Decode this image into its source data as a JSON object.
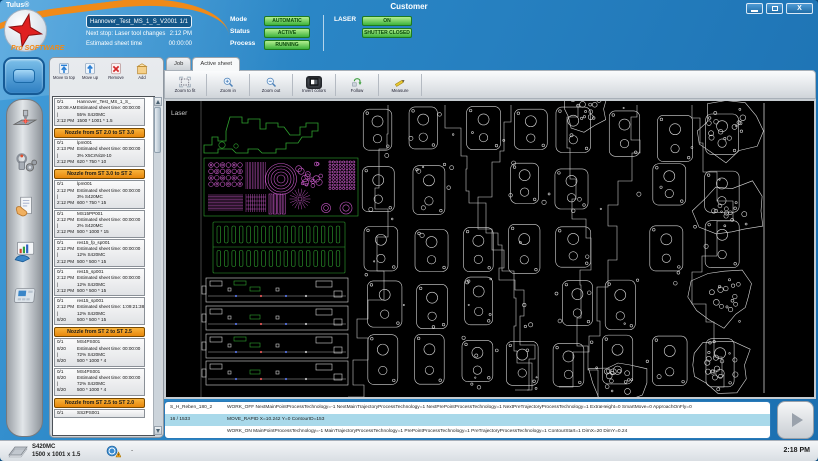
{
  "titlebar": {
    "app_name": "Tulus®",
    "window_title": "Customer"
  },
  "header": {
    "brand": "Pro SOFTWARE",
    "program_name": "Hannover_Test_MS_1_S_V2001",
    "program_count": "1/1",
    "next_stop_label": "Next stop: Laser tool changes",
    "next_stop_value": "2:12 PM",
    "est_sheet_time_label": "Estimated sheet time",
    "est_sheet_time_value": "00:00:00",
    "mode": {
      "label": "Mode",
      "value": "AUTOMATIC"
    },
    "status": {
      "label": "Status",
      "value": "ACTIVE"
    },
    "process": {
      "label": "Process",
      "value": "RUNNING"
    },
    "laser": {
      "label": "LASER",
      "state": "ON",
      "shutter": "SHUTTER CLOSED"
    }
  },
  "sidebar": {
    "active_item": {
      "name": "machine-home-icon"
    },
    "icons": [
      {
        "name": "laser-tool-icon"
      },
      {
        "name": "tool-setup-icon"
      },
      {
        "name": "job-documents-icon"
      },
      {
        "name": "reports-icon"
      },
      {
        "name": "control-panel-icon"
      }
    ]
  },
  "job_panel": {
    "toolbar": [
      {
        "icon": "move-to-top",
        "label": "Move to top"
      },
      {
        "icon": "move-up",
        "label": "Move up"
      },
      {
        "icon": "remove",
        "label": "Remove"
      },
      {
        "icon": "add",
        "label": "Add"
      }
    ],
    "list": [
      {
        "type": "item",
        "rows": [
          [
            "0/1",
            "Hannover_Test_MS_1_S_"
          ],
          [
            "10:08 AM",
            "Estimated sheet time: 00:00:00"
          ],
          [
            "|",
            "55% S420MC"
          ],
          [
            "2:12 PM",
            "1500 * 1001 * 1.5"
          ]
        ]
      },
      {
        "type": "header",
        "label": "Nozzle from ST 2.0 to ST 3.0"
      },
      {
        "type": "item",
        "rows": [
          [
            "0/1",
            "lpm001"
          ],
          [
            "2:13 PM",
            "Estimated sheet time: 00:00:00"
          ],
          [
            "|",
            "3% X5CrNi18-10"
          ],
          [
            "2:12 PM",
            "620 * 750 * 10"
          ]
        ]
      },
      {
        "type": "header",
        "label": "Nozzle from ST 3.0 to ST 2"
      },
      {
        "type": "item",
        "rows": [
          [
            "0/1",
            "lpm001"
          ],
          [
            "2:12 PM",
            "Estimated sheet time: 00:00:00"
          ],
          [
            "|",
            "3% S420MC"
          ],
          [
            "2:12 PM",
            "600 * 750 * 15"
          ]
        ]
      },
      {
        "type": "item",
        "rows": [
          [
            "0/1",
            "MS15PP001"
          ],
          [
            "2:12 PM",
            "Estimated sheet time: 00:00:00"
          ],
          [
            "|",
            "2% S420MC"
          ],
          [
            "2:12 PM",
            "500 * 1000 * 15"
          ]
        ]
      },
      {
        "type": "item",
        "rows": [
          [
            "0/1",
            "res15_fp_sp001"
          ],
          [
            "2:12 PM",
            "Estimated sheet time: 00:00:00"
          ],
          [
            "|",
            "12% S420MC"
          ],
          [
            "2:12 PM",
            "500 * 500 * 15"
          ]
        ]
      },
      {
        "type": "item",
        "rows": [
          [
            "0/1",
            "res15_sp001"
          ],
          [
            "2:12 PM",
            "Estimated sheet time: 00:00:00"
          ],
          [
            "|",
            "12% S420MC"
          ],
          [
            "2:12 PM",
            "500 * 500 * 15"
          ]
        ]
      },
      {
        "type": "item",
        "rows": [
          [
            "0/1",
            "res15_sp001"
          ],
          [
            "2:12 PM",
            "Estimated sheet time: 1:09:21:38"
          ],
          [
            "|",
            "12% S420MC"
          ],
          [
            "8/20",
            "500 * 500 * 15"
          ]
        ]
      },
      {
        "type": "header",
        "label": "Nozzle from ST 2 to ST 2.5"
      },
      {
        "type": "item",
        "rows": [
          [
            "0/1",
            "MS4PS001"
          ],
          [
            "8/20",
            "Estimated sheet time: 00:00:00"
          ],
          [
            "|",
            "72% S420MC"
          ],
          [
            "8/20",
            "500 * 1000 * 4"
          ]
        ]
      },
      {
        "type": "item",
        "rows": [
          [
            "0/1",
            "MS4PS001"
          ],
          [
            "8/20",
            "Estimated sheet time: 00:00:00"
          ],
          [
            "|",
            "72% S420MC"
          ],
          [
            "8/20",
            "500 * 1000 * 4"
          ]
        ]
      },
      {
        "type": "header",
        "label": "Nozzle from ST 2.5 to ST 2.0"
      },
      {
        "type": "item",
        "rows": [
          [
            "0/1",
            "SS2PS001"
          ]
        ]
      }
    ]
  },
  "main": {
    "tabs": [
      {
        "label": "Job",
        "active": false
      },
      {
        "label": "Active sheet",
        "active": true
      }
    ],
    "toolbar": [
      {
        "icon": "zoom-to-fit",
        "label": "Zoom to fit"
      },
      {
        "icon": "zoom-in",
        "label": "Zoom in"
      },
      {
        "icon": "zoom-out",
        "label": "Zoom out"
      },
      {
        "icon": "invert-colors",
        "label": "Invert colors",
        "pressed": true
      },
      {
        "icon": "follow",
        "label": "Follow"
      },
      {
        "icon": "measure",
        "label": "Measure"
      }
    ],
    "canvas_label": "Laser",
    "nc_lines": [
      {
        "label": "S_H_Reben_180_2",
        "text": "WORK_OFF  NextMainPointProcessTechnology=-1  NextMainTrajectoryProcessTechnology=1  NextPrePointProcessTechnology=1  NextPreTrajectoryProcessTechnology=1  ExtraHeight=0  SmartMove=0  ApproachOnFly=0",
        "highlight": false
      },
      {
        "label": "16 / 1533",
        "text": "MOVE_RAPID X=10.242 Y=0 ContourID=153",
        "highlight": true
      },
      {
        "label": "",
        "text": "WORK_ON  MainPointProcessTechnology=-1  MainTrajectoryProcessTechnology=1  PrePointProcessTechnology=1  PreTrajectoryProcessTechnology=1  ContourStart=1  DimX=20  DimY=0.24",
        "highlight": false
      }
    ]
  },
  "statusbar": {
    "material": "S420MC",
    "sheet_size": "1500 x 1001 x 1.5",
    "separator": "-",
    "clock": "2:18 PM"
  },
  "colors": {
    "accent_blue": "#2a86c6",
    "badge_green": "#3cb23c",
    "section_orange": "#f09a18",
    "cad_green": "#2fa32f",
    "cad_magenta": "#c858c8",
    "cad_white": "#d8d8d8",
    "highlight_row": "#a9d9ea"
  }
}
